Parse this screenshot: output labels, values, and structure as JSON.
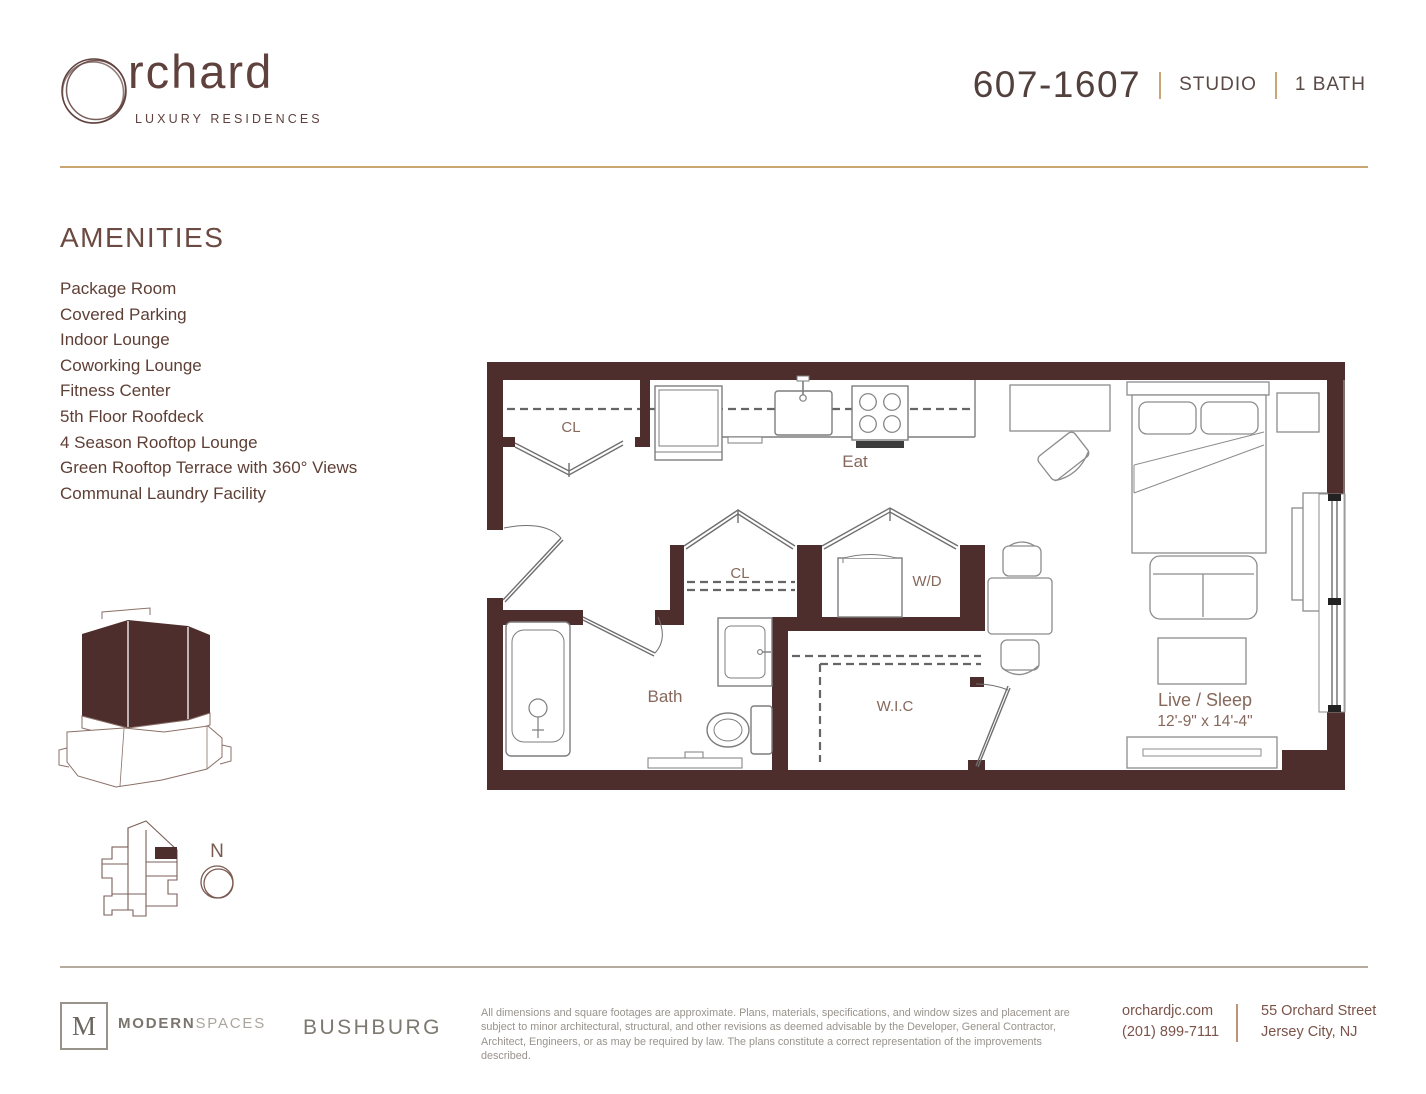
{
  "brand": {
    "wordmark_suffix": "rchard",
    "tagline": "LUXURY RESIDENCES"
  },
  "unit": {
    "number": "607-1607",
    "type": "STUDIO",
    "baths": "1 BATH"
  },
  "amenities": {
    "title": "AMENITIES",
    "items": [
      "Package Room",
      "Covered Parking",
      "Indoor Lounge",
      "Coworking Lounge",
      "Fitness Center",
      "5th Floor Roofdeck",
      "4 Season Rooftop Lounge",
      "Green Rooftop Terrace with 360° Views",
      "Communal Laundry Facility"
    ]
  },
  "floorplan": {
    "labels": {
      "closet1": "CL",
      "eat": "Eat",
      "closet2": "CL",
      "washer_dryer": "W/D",
      "bath": "Bath",
      "wic": "W.I.C",
      "live_sleep": "Live / Sleep",
      "live_sleep_dimensions": "12'-9\" x 14'-4\""
    }
  },
  "compass": {
    "north_label": "N"
  },
  "footer": {
    "modern_spaces": {
      "monogram": "M",
      "name_bold": "MODERN",
      "name_light": "SPACES"
    },
    "bushburg": "BUSHBURG",
    "disclaimer": "All dimensions and square footages are approximate. Plans, materials, specifications, and window sizes and placement are subject to minor architectural, structural, and other revisions as deemed advisable by the Developer, General Contractor, Architect, Engineers, or as may be required by law. The plans constitute a correct representation of the improvements described.",
    "contact": {
      "website": "orchardjc.com",
      "phone": "(201) 899-7111",
      "address_line1": "55 Orchard Street",
      "address_line2": "Jersey City, NJ"
    }
  },
  "colors": {
    "wall_maroon": "#4e2d2d",
    "brand_maroon": "#5f413d",
    "accent_gold": "#c9a571",
    "body_brown": "#5e3f35",
    "footer_gray": "#7d7870",
    "contact_brown": "#7b5349"
  }
}
